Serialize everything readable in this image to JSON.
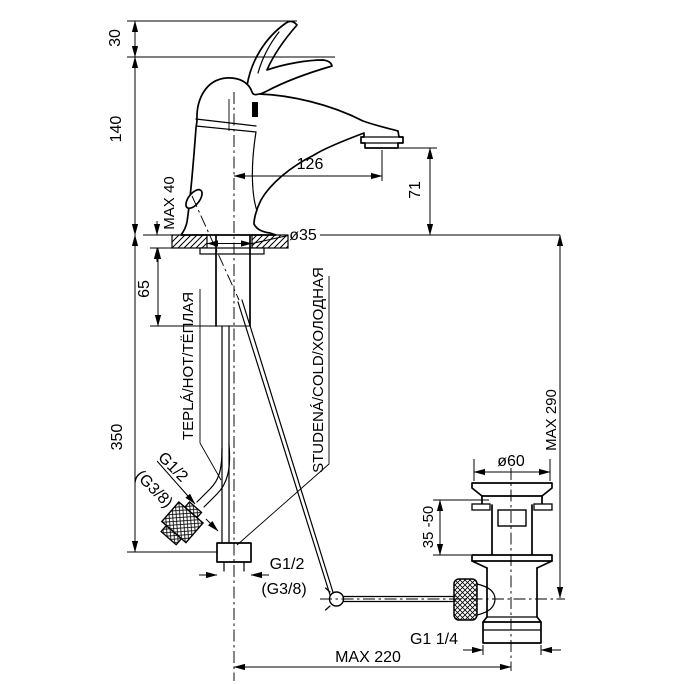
{
  "colors": {
    "background": "#ffffff",
    "line": "#000000"
  },
  "dimensions": {
    "handle_lift": "30",
    "body_height": "140",
    "deck_thickness_max": "MAX 40",
    "shank_length": "65",
    "hose_length": "350",
    "spout_reach": "126",
    "spout_height": "71",
    "mount_hole_diameter": "ø35",
    "rod_height_max": "MAX 290",
    "drain_flange_diameter": "ø60",
    "basin_thickness_range": "35 -50",
    "rod_reach_max": "MAX 220"
  },
  "labels": {
    "hot_water": "TEPLÁ/HOT/ТЁПЛАЯ",
    "cold_water": "STUDENÁ/COLD/ХОЛОДНАЯ",
    "hose_thread": "G1/2",
    "hose_thread_alt": "(G3/8)",
    "shank_thread": "G1/2",
    "shank_thread_alt": "(G3/8)",
    "drain_thread": "G1 1/4"
  }
}
